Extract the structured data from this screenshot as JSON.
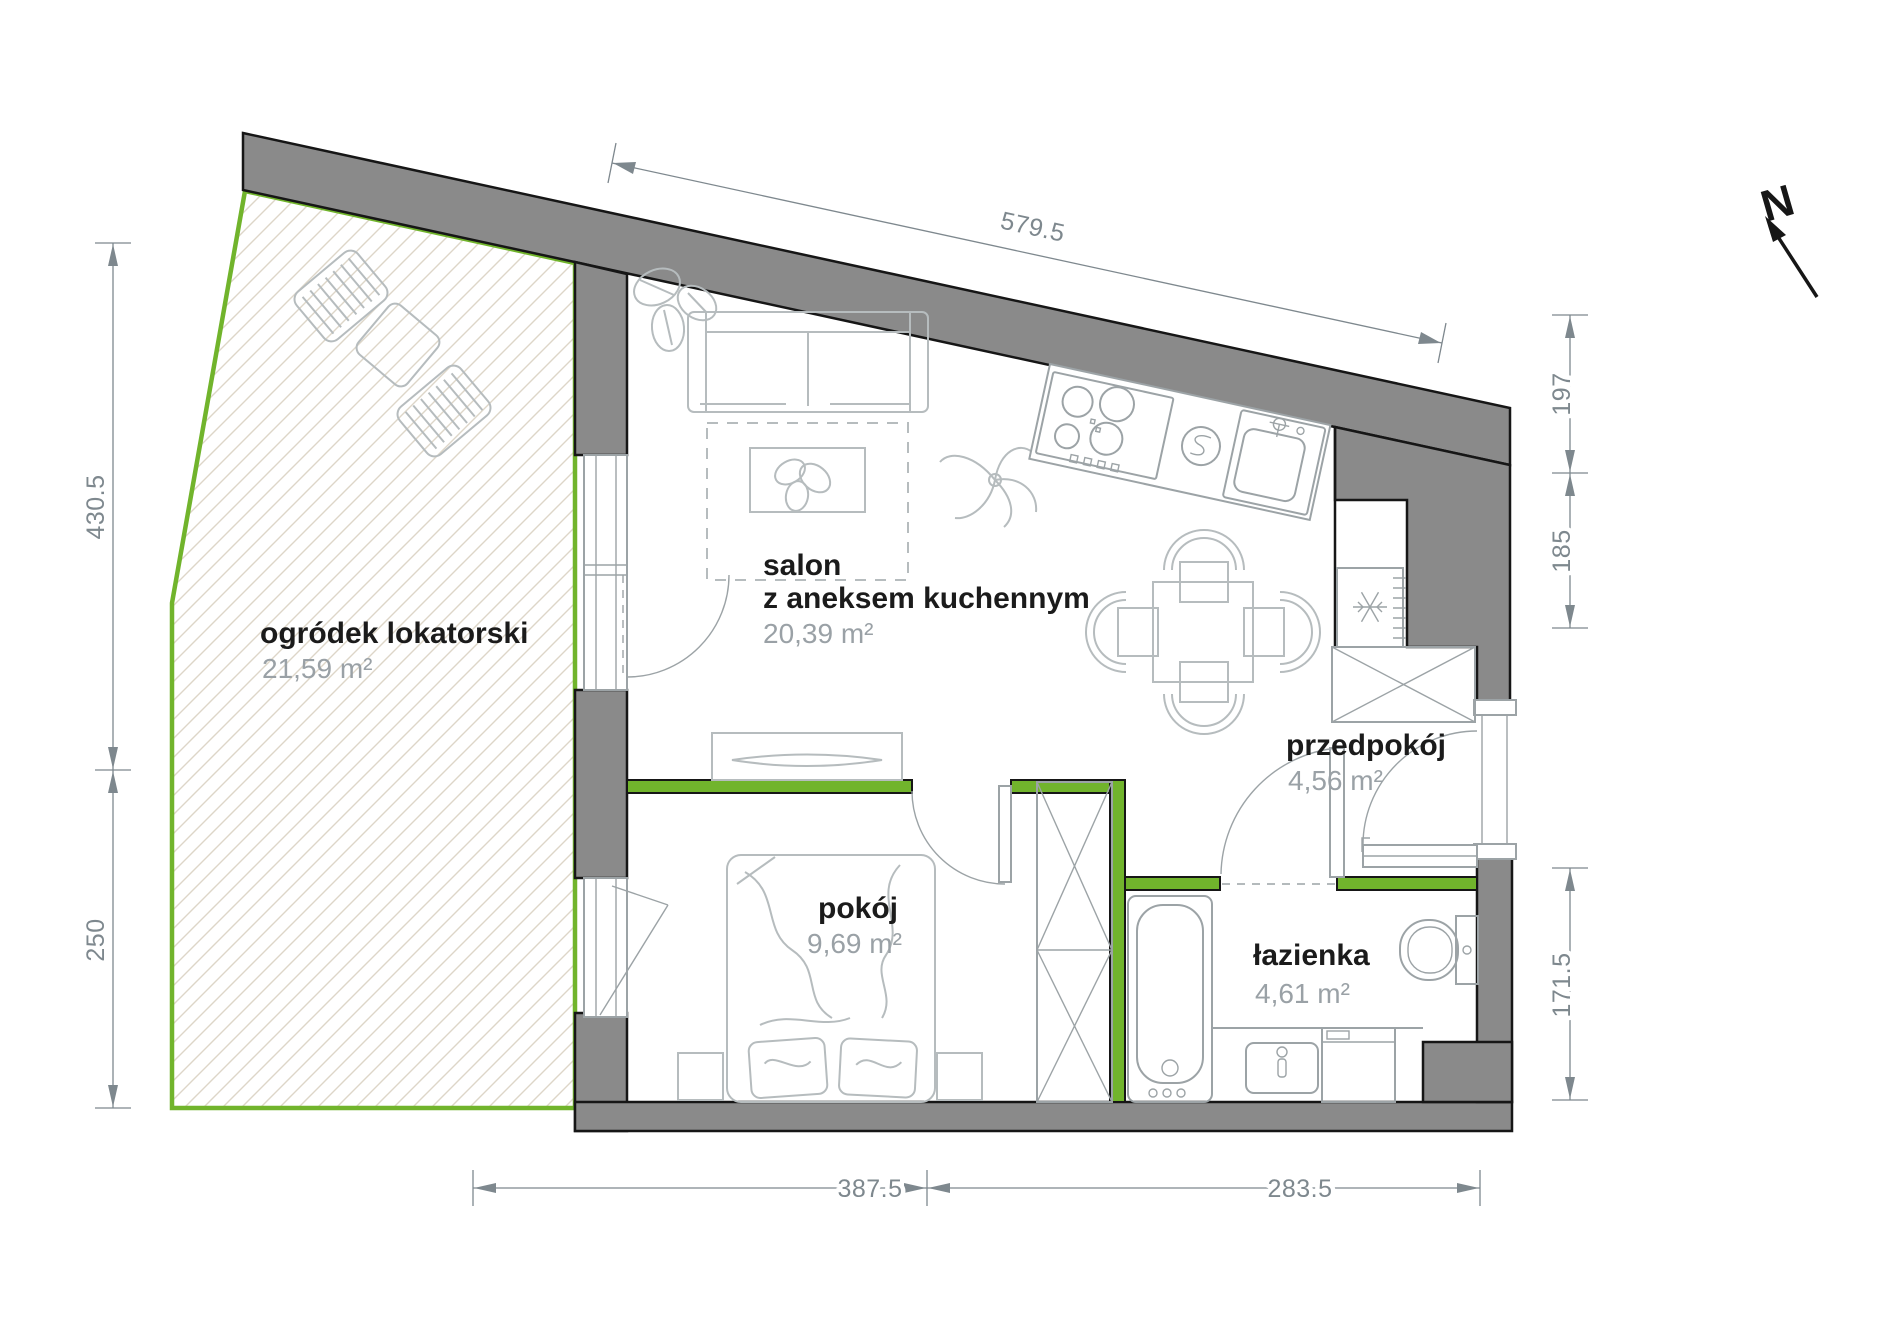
{
  "plan_type": "apartment-floor-plan",
  "rooms": {
    "garden": {
      "label": "ogródek lokatorski",
      "area": "21,59 m²"
    },
    "living": {
      "label_line1": "salon",
      "label_line2": "z aneksem kuchennym",
      "area": "20,39 m²"
    },
    "bedroom": {
      "label": "pokój",
      "area": "9,69 m²"
    },
    "hall": {
      "label": "przedpokój",
      "area": "4,56 m²"
    },
    "bath": {
      "label": "łazienka",
      "area": "4,61 m²"
    }
  },
  "dimensions": {
    "top": "579.5",
    "left_upper": "430.5",
    "left_lower": "250",
    "right_upper": "197",
    "right_middle": "185",
    "right_lower": "171.5",
    "bottom_left": "387.5",
    "bottom_right": "283.5"
  },
  "compass": {
    "label": "N"
  },
  "colors": {
    "wall": "#8a8a8a",
    "wall_outline": "#161616",
    "green": "#71b42c",
    "hatch": "#ddd6c8",
    "furniture": "#b6bcbe",
    "fixture": "#9ca3a6",
    "dim": "#7e888e",
    "label": "#1b1b1b",
    "area_text": "#9aa1a6"
  }
}
